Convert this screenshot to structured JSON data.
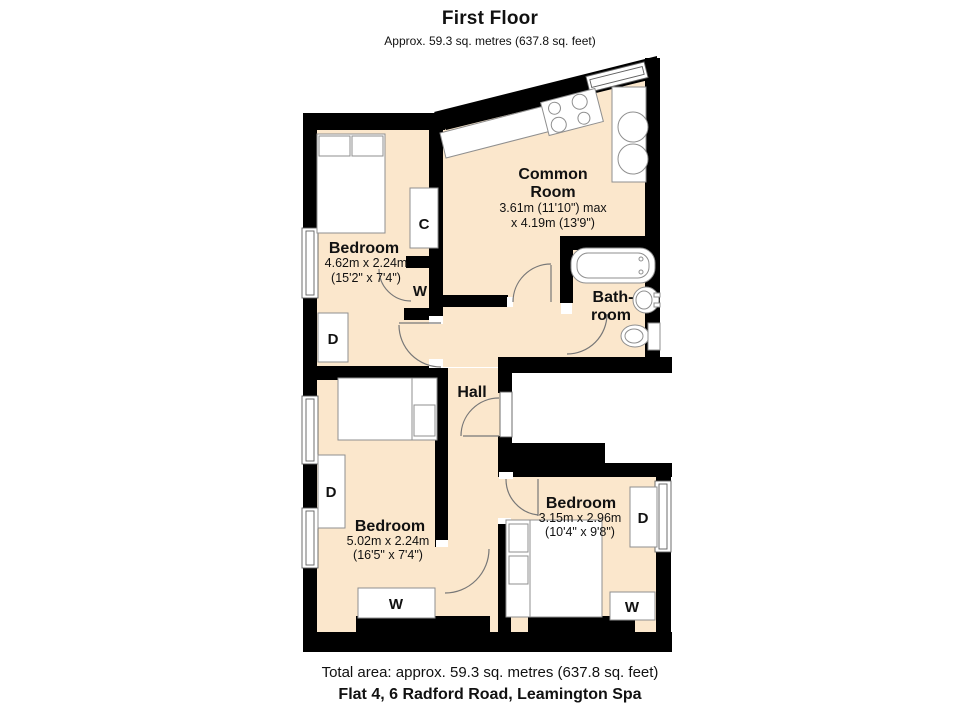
{
  "header": {
    "title": "First Floor",
    "subtitle": "Approx. 59.3 sq. metres (637.8 sq. feet)"
  },
  "footer": {
    "total_area": "Total area: approx. 59.3 sq. metres (637.8 sq. feet)",
    "address": "Flat 4, 6 Radford Road, Leamington Spa"
  },
  "rooms": {
    "common_room": {
      "name_line1": "Common",
      "name_line2": "Room",
      "dims_line1": "3.61m (11'10\") max",
      "dims_line2": "x 4.19m (13'9\")"
    },
    "bedroom1": {
      "name": "Bedroom",
      "dims_metric": "4.62m x 2.24m",
      "dims_imperial": "(15'2\" x 7'4\")"
    },
    "bathroom": {
      "name_line1": "Bath-",
      "name_line2": "room"
    },
    "hall": {
      "name": "Hall"
    },
    "bedroom2": {
      "name": "Bedroom",
      "dims_metric": "5.02m x 2.24m",
      "dims_imperial": "(16'5\" x 7'4\")"
    },
    "bedroom3": {
      "name": "Bedroom",
      "dims_metric": "3.15m x 2.96m",
      "dims_imperial": "(10'4\" x 9'8\")"
    }
  },
  "furniture_labels": {
    "cupboard": "C",
    "wardrobe": "W",
    "drawers": "D"
  },
  "colors": {
    "floor": "#fbe7cc",
    "wall": "#000000"
  }
}
